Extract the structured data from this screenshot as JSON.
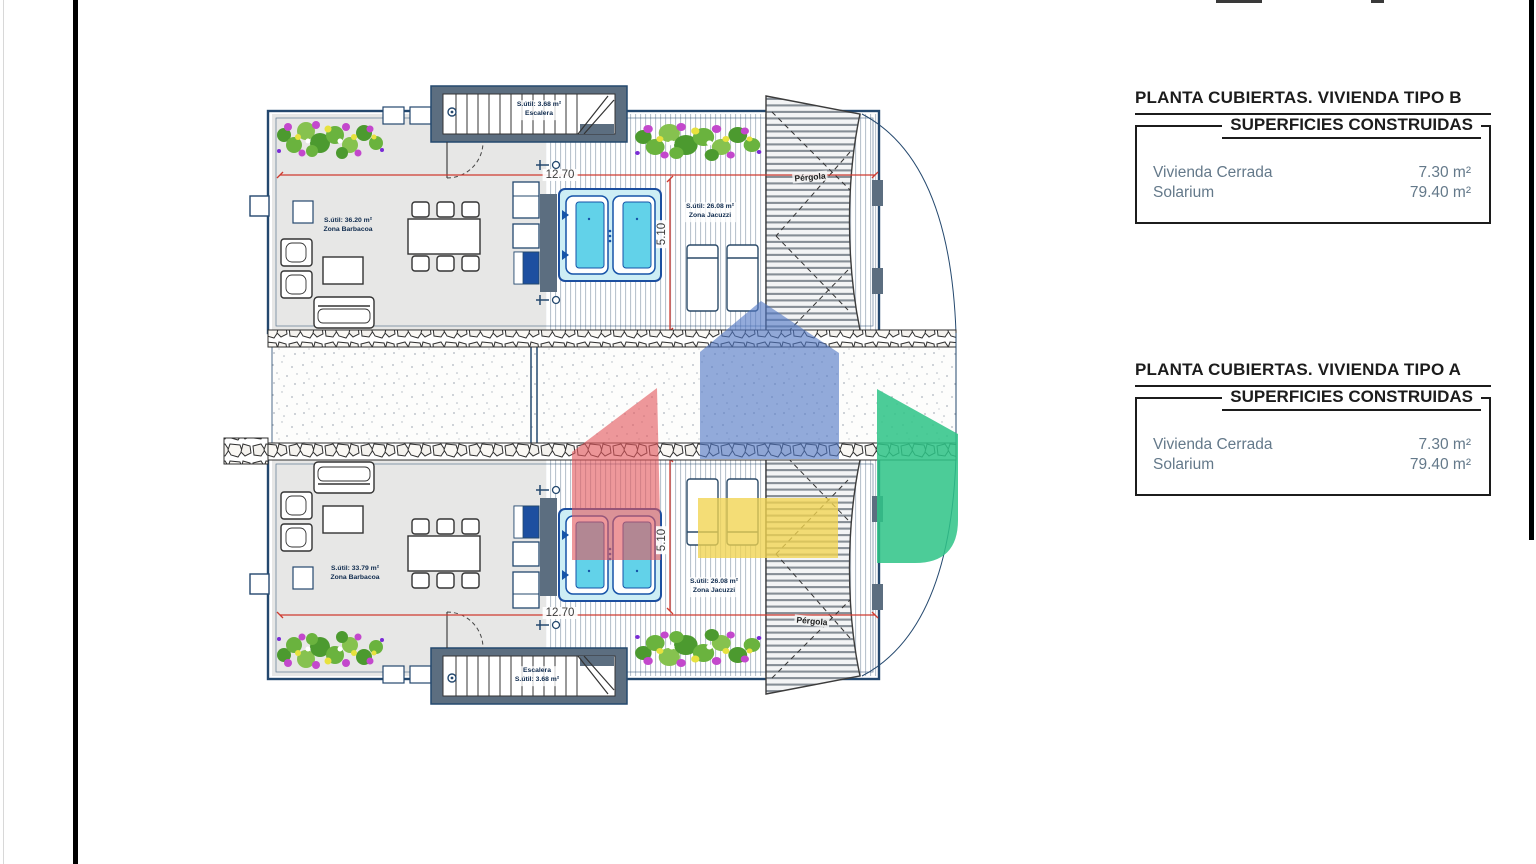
{
  "panels": [
    {
      "title": "PLANTA CUBIERTAS. VIVIENDA TIPO B",
      "subtitle": "SUPERFICIES CONSTRUIDAS",
      "rows": [
        {
          "label": "Vivienda Cerrada",
          "value": "7.30 m²"
        },
        {
          "label": "Solarium",
          "value": "79.40 m²"
        }
      ]
    },
    {
      "title": "PLANTA CUBIERTAS. VIVIENDA TIPO A",
      "subtitle": "SUPERFICIES CONSTRUIDAS",
      "rows": [
        {
          "label": "Vivienda Cerrada",
          "value": "7.30 m²"
        },
        {
          "label": "Solarium",
          "value": "79.40 m²"
        }
      ]
    }
  ],
  "plan": {
    "stair_top": {
      "area": "S.útil: 3.68 m²",
      "name": "Escalera"
    },
    "stair_bottom": {
      "name": "Escalera",
      "area": "S.útil: 3.68 m²"
    },
    "barbacoa_top": {
      "area": "S.útil: 36.20 m²",
      "name": "Zona Barbacoa"
    },
    "barbacoa_bottom": {
      "area": "S.útil: 33.79 m²",
      "name": "Zona Barbacoa"
    },
    "jacuzzi_top": {
      "area": "S.útil: 26.08 m²",
      "name": "Zona Jacuzzi"
    },
    "jacuzzi_bottom": {
      "area": "S.útil: 26.08 m²",
      "name": "Zona Jacuzzi"
    },
    "dimensions": {
      "width": "12.70",
      "depth": "5.10"
    },
    "pergola_label": "Pérgola"
  },
  "colors": {
    "plan_line": "#24486e",
    "wall_fill": "#5c6e80",
    "dimension_red": "#cf3b30",
    "jacuzzi_cyan": "#62d2e9",
    "logo_blue": "#5077c5",
    "logo_red": "#e4595e",
    "logo_yellow": "#f1d44f",
    "logo_green": "#2ec487"
  }
}
